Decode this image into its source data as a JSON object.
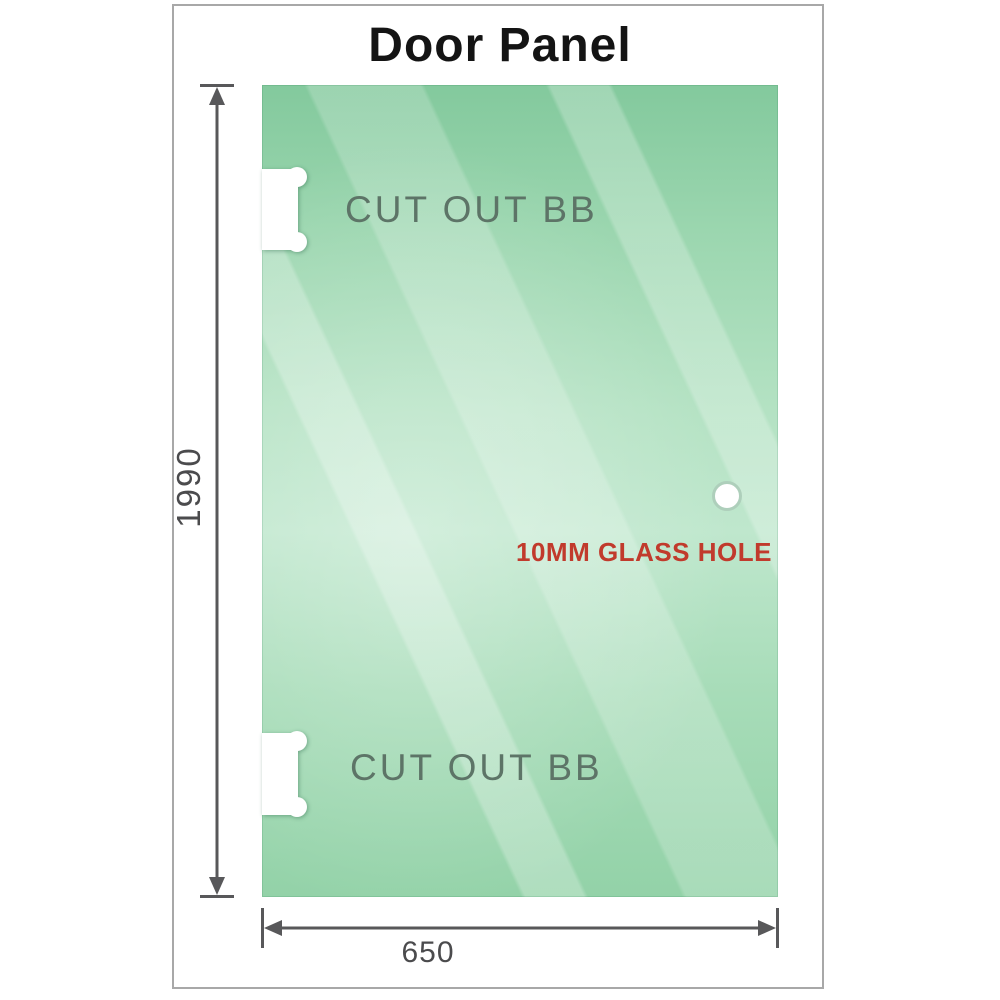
{
  "title": "Door Panel",
  "panel": {
    "cutouts": [
      {
        "label": "CUT OUT BB"
      },
      {
        "label": "CUT OUT BB"
      }
    ],
    "hole": {
      "label": "10MM GLASS HOLE"
    }
  },
  "dimensions": {
    "height": "1990",
    "width": "650"
  },
  "colors": {
    "glass_base": "#93d2a8",
    "glass_light": "#bfe7cd",
    "dimension_line": "#58585a",
    "hole_label": "#c13a2c",
    "cutout_label": "#5d7467",
    "frame_border": "#a8a8a8",
    "title_text": "#141414"
  }
}
